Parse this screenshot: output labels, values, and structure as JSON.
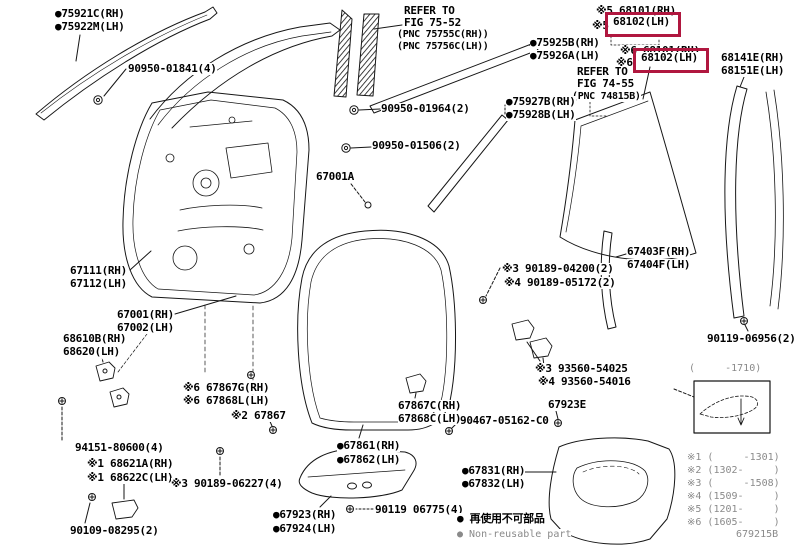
{
  "colors": {
    "highlight_box": "#b0173f",
    "ink": "#000000",
    "muted": "#8a8a8a",
    "background": "#ffffff"
  },
  "figure_code": "679215B",
  "highlight_boxes": [
    {
      "x": 605,
      "y": 12,
      "w": 70,
      "h": 19,
      "for_part": "68102(LH)"
    },
    {
      "x": 633,
      "y": 48,
      "w": 70,
      "h": 19,
      "for_part": "68102(LH)"
    }
  ],
  "labels": [
    {
      "n": "callout-75921c-rh",
      "t": "●75921C(RH)",
      "x": 55,
      "y": 8,
      "c": "pt",
      "i": true
    },
    {
      "n": "callout-75922m-lh",
      "t": "●75922M(LH)",
      "x": 55,
      "y": 21,
      "c": "pt",
      "i": true
    },
    {
      "n": "callout-90950-01841",
      "t": "90950-01841(4)",
      "x": 128,
      "y": 63,
      "c": "pt",
      "i": true
    },
    {
      "n": "note-refer-fig7552-1",
      "t": "REFER TO",
      "x": 404,
      "y": 5,
      "c": "pt",
      "i": false
    },
    {
      "n": "note-refer-fig7552-2",
      "t": "FIG 75-52",
      "x": 404,
      "y": 17,
      "c": "pt",
      "i": false
    },
    {
      "n": "note-refer-fig7552-3",
      "t": "(PNC 75755C(RH))",
      "x": 397,
      "y": 29,
      "c": "sm",
      "i": false
    },
    {
      "n": "note-refer-fig7552-4",
      "t": "(PNC 75756C(LH))",
      "x": 397,
      "y": 41,
      "c": "sm",
      "i": false
    },
    {
      "n": "callout-75925b-rh",
      "t": "●75925B(RH)",
      "x": 530,
      "y": 37,
      "c": "pt",
      "i": true
    },
    {
      "n": "callout-75926a-lh",
      "t": "●75926A(LH)",
      "x": 530,
      "y": 50,
      "c": "pt",
      "i": true
    },
    {
      "n": "callout-68101-rh-1",
      "t": "※5 68101(RH)",
      "x": 596,
      "y": 5,
      "c": "pt",
      "i": true
    },
    {
      "n": "callout-68102-mark-1",
      "t": "※5",
      "x": 592,
      "y": 20,
      "c": "pt",
      "i": false
    },
    {
      "n": "callout-68102-lh-1",
      "t": "68102(LH)",
      "x": 613,
      "y": 16,
      "c": "pt",
      "i": true
    },
    {
      "n": "callout-68101-rh-2",
      "t": "※6 68101(RH)",
      "x": 620,
      "y": 45,
      "c": "pt",
      "i": true
    },
    {
      "n": "callout-68102-mark-2",
      "t": "※6",
      "x": 616,
      "y": 57,
      "c": "pt",
      "i": false
    },
    {
      "n": "callout-68102-lh-2",
      "t": "68102(LH)",
      "x": 641,
      "y": 52,
      "c": "pt",
      "i": true
    },
    {
      "n": "note-refer-fig7455-1",
      "t": "REFER TO",
      "x": 577,
      "y": 66,
      "c": "pt",
      "i": false
    },
    {
      "n": "note-refer-fig7455-2",
      "t": "FIG 74-55",
      "x": 577,
      "y": 78,
      "c": "pt",
      "i": false
    },
    {
      "n": "note-refer-fig7455-3",
      "t": "(PNC 74815B)",
      "x": 572,
      "y": 91,
      "c": "sm",
      "i": false
    },
    {
      "n": "callout-68141e-rh",
      "t": "68141E(RH)",
      "x": 721,
      "y": 52,
      "c": "pt",
      "i": true
    },
    {
      "n": "callout-68151e-lh",
      "t": "68151E(LH)",
      "x": 721,
      "y": 65,
      "c": "pt",
      "i": true
    },
    {
      "n": "callout-90950-01964",
      "t": "90950-01964(2)",
      "x": 381,
      "y": 103,
      "c": "pt",
      "i": true
    },
    {
      "n": "callout-75927b-rh",
      "t": "●75927B(RH)",
      "x": 506,
      "y": 96,
      "c": "pt",
      "i": true
    },
    {
      "n": "callout-75928b-lh",
      "t": "●75928B(LH)",
      "x": 506,
      "y": 109,
      "c": "pt",
      "i": true
    },
    {
      "n": "callout-90950-01506",
      "t": "90950-01506(2)",
      "x": 372,
      "y": 140,
      "c": "pt",
      "i": true
    },
    {
      "n": "callout-67001a",
      "t": "67001A",
      "x": 316,
      "y": 171,
      "c": "pt",
      "i": true
    },
    {
      "n": "callout-67111-rh",
      "t": "67111(RH)",
      "x": 70,
      "y": 265,
      "c": "pt",
      "i": true
    },
    {
      "n": "callout-67112-lh",
      "t": "67112(LH)",
      "x": 70,
      "y": 278,
      "c": "pt",
      "i": true
    },
    {
      "n": "callout-67001-rh",
      "t": "67001(RH)",
      "x": 117,
      "y": 309,
      "c": "pt",
      "i": true
    },
    {
      "n": "callout-67002-lh",
      "t": "67002(LH)",
      "x": 117,
      "y": 322,
      "c": "pt",
      "i": true
    },
    {
      "n": "callout-68610b-rh",
      "t": "68610B(RH)",
      "x": 63,
      "y": 333,
      "c": "pt",
      "i": true
    },
    {
      "n": "callout-68620-lh",
      "t": "68620(LH)",
      "x": 63,
      "y": 346,
      "c": "pt",
      "i": true
    },
    {
      "n": "callout-67403f-rh",
      "t": "67403F(RH)",
      "x": 627,
      "y": 246,
      "c": "pt",
      "i": true
    },
    {
      "n": "callout-90189-04200",
      "t": "※3 90189-04200(2)",
      "x": 502,
      "y": 263,
      "c": "pt",
      "i": true
    },
    {
      "n": "callout-90189-05172",
      "t": "※4 90189-05172(2)",
      "x": 504,
      "y": 277,
      "c": "pt",
      "i": true
    },
    {
      "n": "callout-67404f-lh",
      "t": "67404F(LH)",
      "x": 627,
      "y": 259,
      "c": "pt",
      "i": true
    },
    {
      "n": "callout-90119-06956",
      "t": "90119-06956(2)",
      "x": 707,
      "y": 333,
      "c": "pt",
      "i": true
    },
    {
      "n": "callout-93560-54025",
      "t": "※3 93560-54025",
      "x": 535,
      "y": 363,
      "c": "pt",
      "i": true
    },
    {
      "n": "callout-93560-54016",
      "t": "※4 93560-54016",
      "x": 538,
      "y": 376,
      "c": "pt",
      "i": true
    },
    {
      "n": "callout-67867g-rh",
      "t": "※6 67867G(RH)",
      "x": 183,
      "y": 382,
      "c": "pt",
      "i": true
    },
    {
      "n": "callout-67868l-lh",
      "t": "※6 67868L(LH)",
      "x": 183,
      "y": 395,
      "c": "pt",
      "i": true
    },
    {
      "n": "callout-67867",
      "t": "※2 67867",
      "x": 231,
      "y": 410,
      "c": "pt",
      "i": true
    },
    {
      "n": "callout-67867c-rh",
      "t": "67867C(RH)",
      "x": 398,
      "y": 400,
      "c": "pt",
      "i": true
    },
    {
      "n": "callout-67868c-lh",
      "t": "67868C(LH)",
      "x": 398,
      "y": 413,
      "c": "pt",
      "i": true
    },
    {
      "n": "callout-90467-05162",
      "t": "90467-05162-C0",
      "x": 460,
      "y": 415,
      "c": "pt",
      "i": true
    },
    {
      "n": "callout-67923e",
      "t": "67923E",
      "x": 548,
      "y": 399,
      "c": "pt",
      "i": true
    },
    {
      "n": "callout-94151-80600",
      "t": "94151-80600(4)",
      "x": 75,
      "y": 442,
      "c": "pt",
      "i": true
    },
    {
      "n": "callout-68621a-rh",
      "t": "※1 68621A(RH)",
      "x": 87,
      "y": 458,
      "c": "pt",
      "i": true
    },
    {
      "n": "callout-68622c-lh",
      "t": "※1 68622C(LH)",
      "x": 87,
      "y": 472,
      "c": "pt",
      "i": true
    },
    {
      "n": "callout-67861-rh",
      "t": "●67861(RH)",
      "x": 337,
      "y": 440,
      "c": "pt",
      "i": true
    },
    {
      "n": "callout-67862-lh",
      "t": "●67862(LH)",
      "x": 337,
      "y": 454,
      "c": "pt",
      "i": true
    },
    {
      "n": "callout-90189-06227",
      "t": "※3 90189-06227(4)",
      "x": 171,
      "y": 478,
      "c": "pt",
      "i": true
    },
    {
      "n": "callout-67831-rh",
      "t": "●67831(RH)",
      "x": 462,
      "y": 465,
      "c": "pt",
      "i": true
    },
    {
      "n": "callout-67832-lh",
      "t": "●67832(LH)",
      "x": 462,
      "y": 478,
      "c": "pt",
      "i": true
    },
    {
      "n": "callout-90119-06775",
      "t": "90119 06775(4)",
      "x": 375,
      "y": 504,
      "c": "pt",
      "i": true
    },
    {
      "n": "callout-67923-rh",
      "t": "●67923(RH)",
      "x": 273,
      "y": 509,
      "c": "pt",
      "i": true
    },
    {
      "n": "callout-67924-lh",
      "t": "●67924(LH)",
      "x": 273,
      "y": 523,
      "c": "pt",
      "i": true
    },
    {
      "n": "callout-90109-08295",
      "t": "90109-08295(2)",
      "x": 70,
      "y": 525,
      "c": "pt",
      "i": true
    },
    {
      "n": "note-non-reusable-jp",
      "t": "● 再使用不可部品",
      "x": 457,
      "y": 513,
      "c": "pt",
      "i": false
    },
    {
      "n": "note-non-reusable-en",
      "t": "● Non-reusable part",
      "x": 457,
      "y": 529,
      "c": "mut",
      "i": false
    },
    {
      "n": "legend-header-range",
      "t": "(     -1710)",
      "x": 689,
      "y": 363,
      "c": "mut",
      "i": false
    },
    {
      "n": "legend-entry-1",
      "t": "※1 (     -1301)",
      "x": 687,
      "y": 452,
      "c": "mut",
      "i": false
    },
    {
      "n": "legend-entry-2",
      "t": "※2 (1302-     )",
      "x": 687,
      "y": 465,
      "c": "mut",
      "i": false
    },
    {
      "n": "legend-entry-3",
      "t": "※3 (     -1508)",
      "x": 687,
      "y": 478,
      "c": "mut",
      "i": false
    },
    {
      "n": "legend-entry-4",
      "t": "※4 (1509-     )",
      "x": 687,
      "y": 491,
      "c": "mut",
      "i": false
    },
    {
      "n": "legend-entry-5",
      "t": "※5 (1201-     )",
      "x": 687,
      "y": 504,
      "c": "mut",
      "i": false
    },
    {
      "n": "legend-entry-6",
      "t": "※6 (1605-     )",
      "x": 687,
      "y": 517,
      "c": "mut",
      "i": false
    },
    {
      "n": "figure-code",
      "t": "679215B",
      "x": 736,
      "y": 529,
      "c": "mut",
      "i": false
    }
  ]
}
